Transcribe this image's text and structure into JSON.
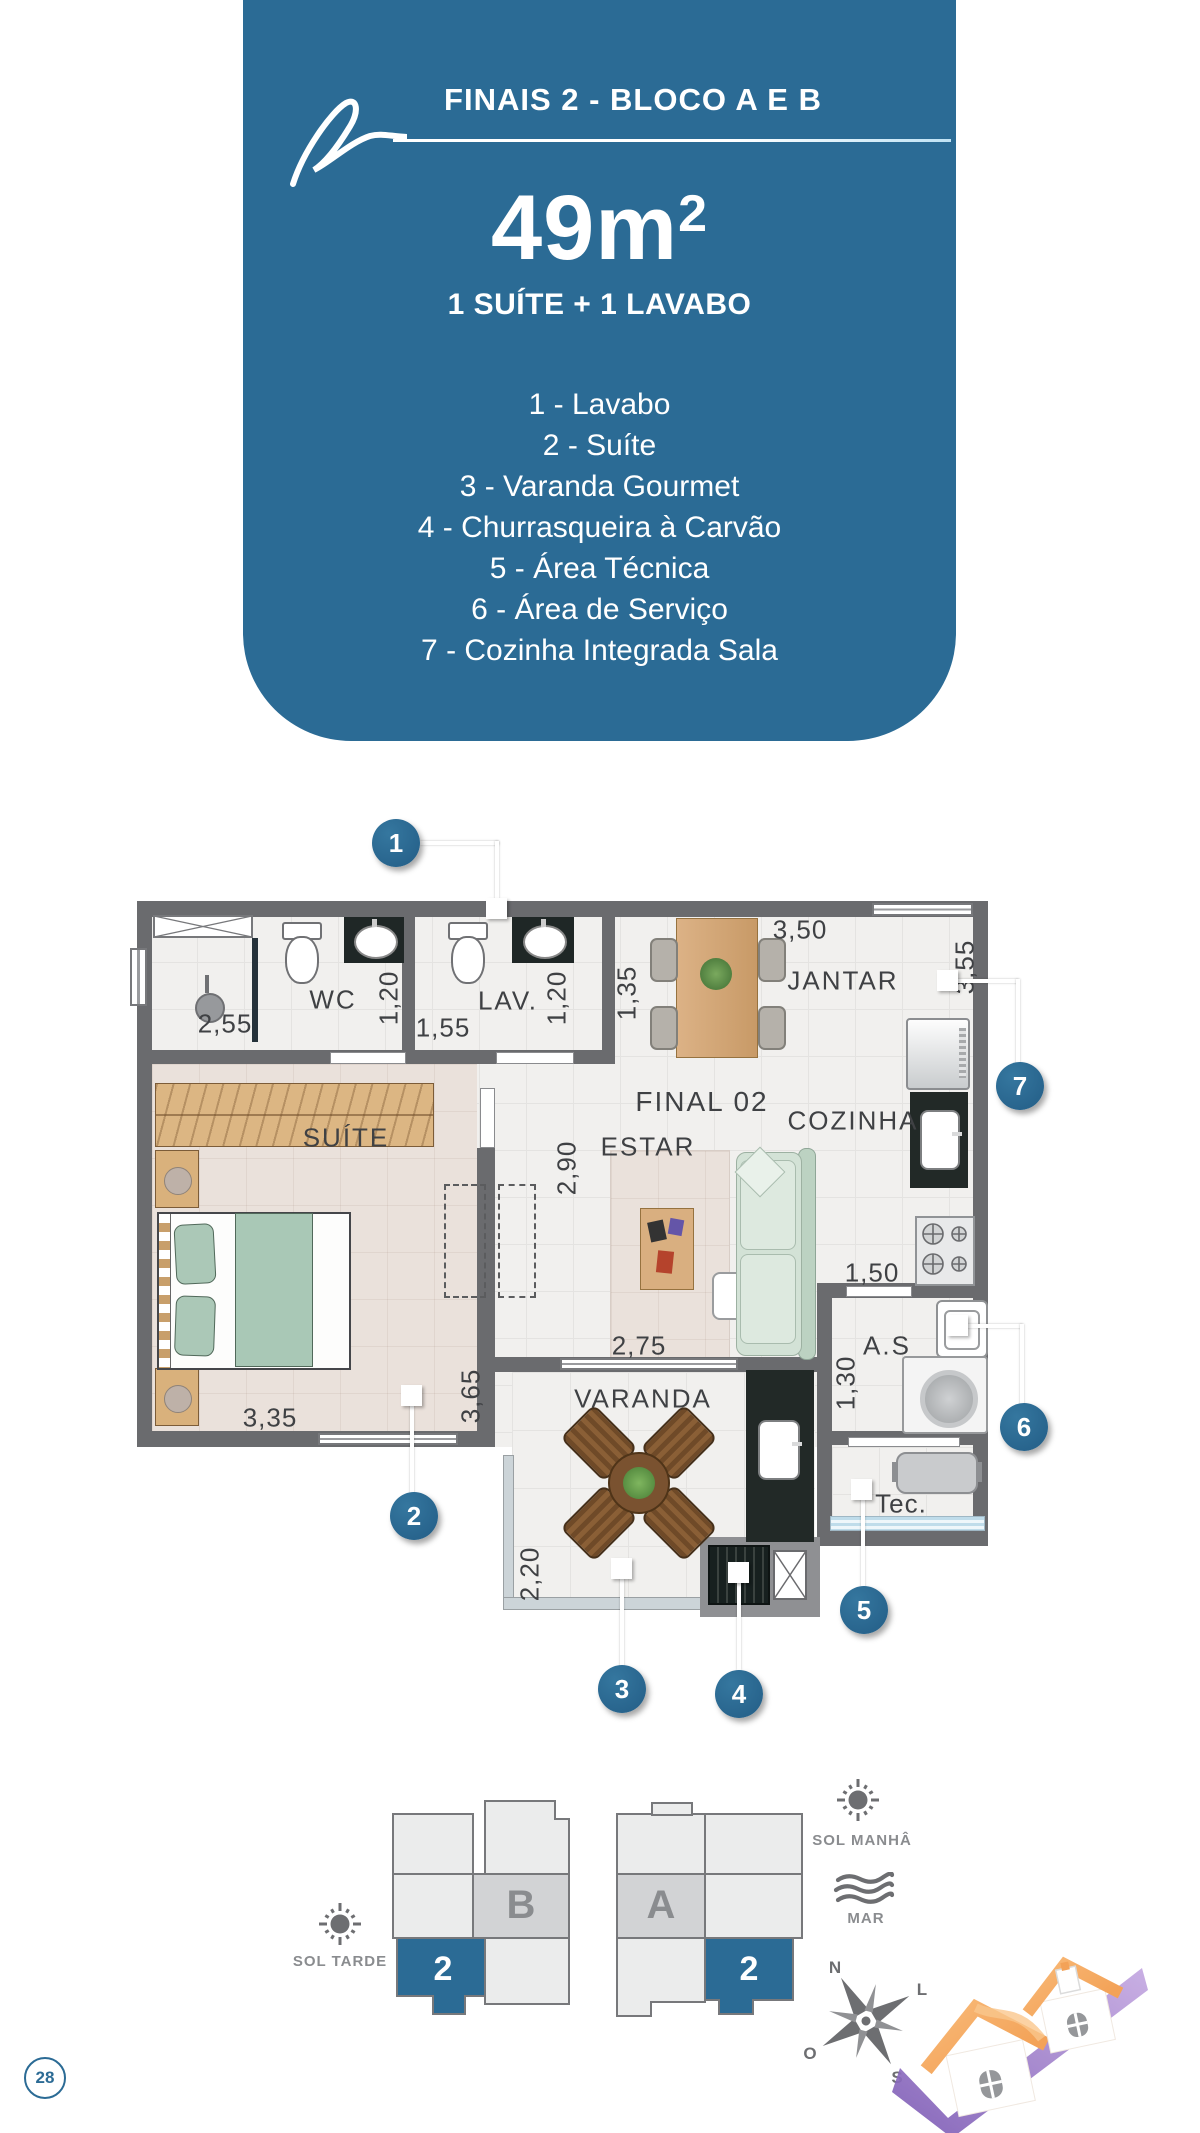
{
  "header": {
    "title": "FINAIS 2 - BLOCO A E B",
    "area_base": "49m",
    "area_exp": "2",
    "subtitle": "1 SUÍTE + 1 LAVABO",
    "legend": [
      "1 - Lavabo",
      "2 - Suíte",
      "3 - Varanda Gourmet",
      "4 - Churrasqueira à Carvão",
      "5 - Área Técnica",
      "6 - Área de Serviço",
      "7 - Cozinha Integrada Sala"
    ]
  },
  "plan": {
    "unit": "FINAL 02",
    "rooms": {
      "wc": "WC",
      "lav": "LAV.",
      "jantar": "JANTAR",
      "suite": "SUÍTE",
      "estar": "ESTAR",
      "cozinha": "COZINHA",
      "varanda": "VARANDA",
      "servico": "A.S",
      "tec": "Tec."
    },
    "dims": {
      "wc_w": "2,55",
      "wc_h": "1,20",
      "lav_w": "1,55",
      "lav_h": "1,20",
      "jantar_l": "1,35",
      "jantar_w": "3,50",
      "jantar_r": "3,55",
      "hall": "2,90",
      "suite_w": "3,35",
      "suite_h": "3,65",
      "estar_w": "2,75",
      "cozinha_w": "1,50",
      "servico_h": "1,30",
      "varanda_h": "2,20"
    },
    "callouts": [
      "1",
      "2",
      "3",
      "4",
      "5",
      "6",
      "7"
    ]
  },
  "blocks": {
    "b": {
      "name": "B",
      "unit": "2"
    },
    "a": {
      "name": "A",
      "unit": "2"
    }
  },
  "orientation": {
    "sol_tarde": "SOL TARDE",
    "sol_manha": "SOL MANHÂ",
    "mar": "MAR",
    "compass": {
      "n": "N",
      "l": "L",
      "s": "S",
      "o": "O"
    }
  },
  "footer": {
    "page": "28"
  },
  "colors": {
    "accent": "#2b6b95",
    "wall": "#6a6b6e",
    "icon": "#6d6e71"
  }
}
